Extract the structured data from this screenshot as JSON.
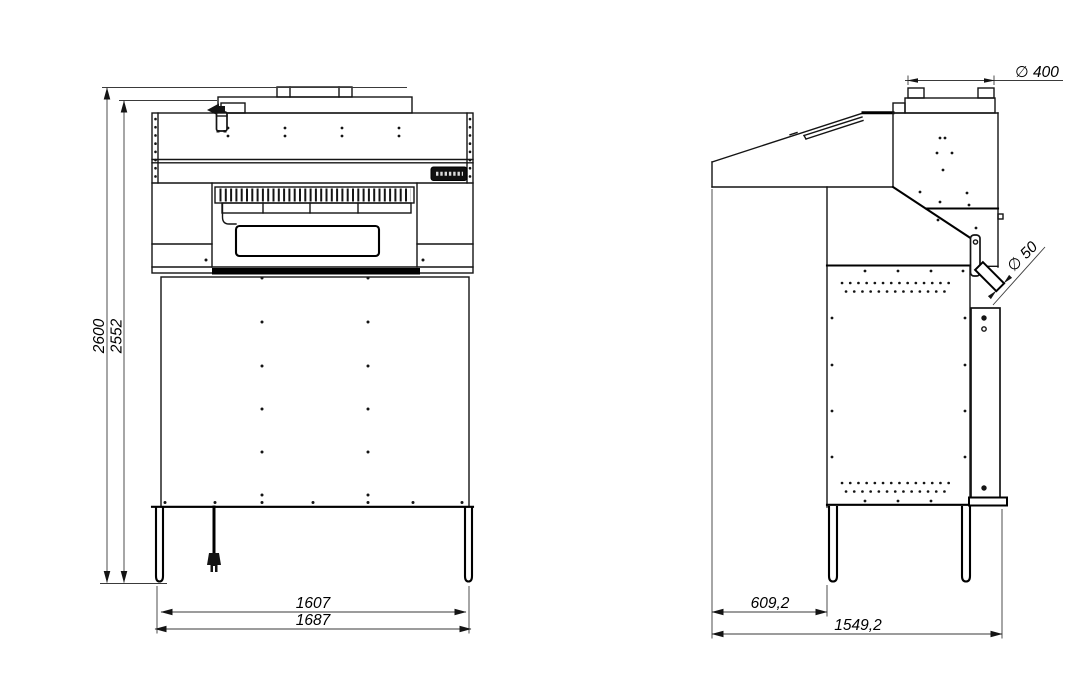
{
  "drawing": {
    "front_view": {
      "height_total": "2600",
      "height_body": "2552",
      "width_inner": "1607",
      "width_overall": "1687"
    },
    "side_view": {
      "depth_front": "609,2",
      "depth_overall": "1549,2",
      "duct_diameter": "∅ 400",
      "outlet_diameter": "∅ 50"
    }
  }
}
